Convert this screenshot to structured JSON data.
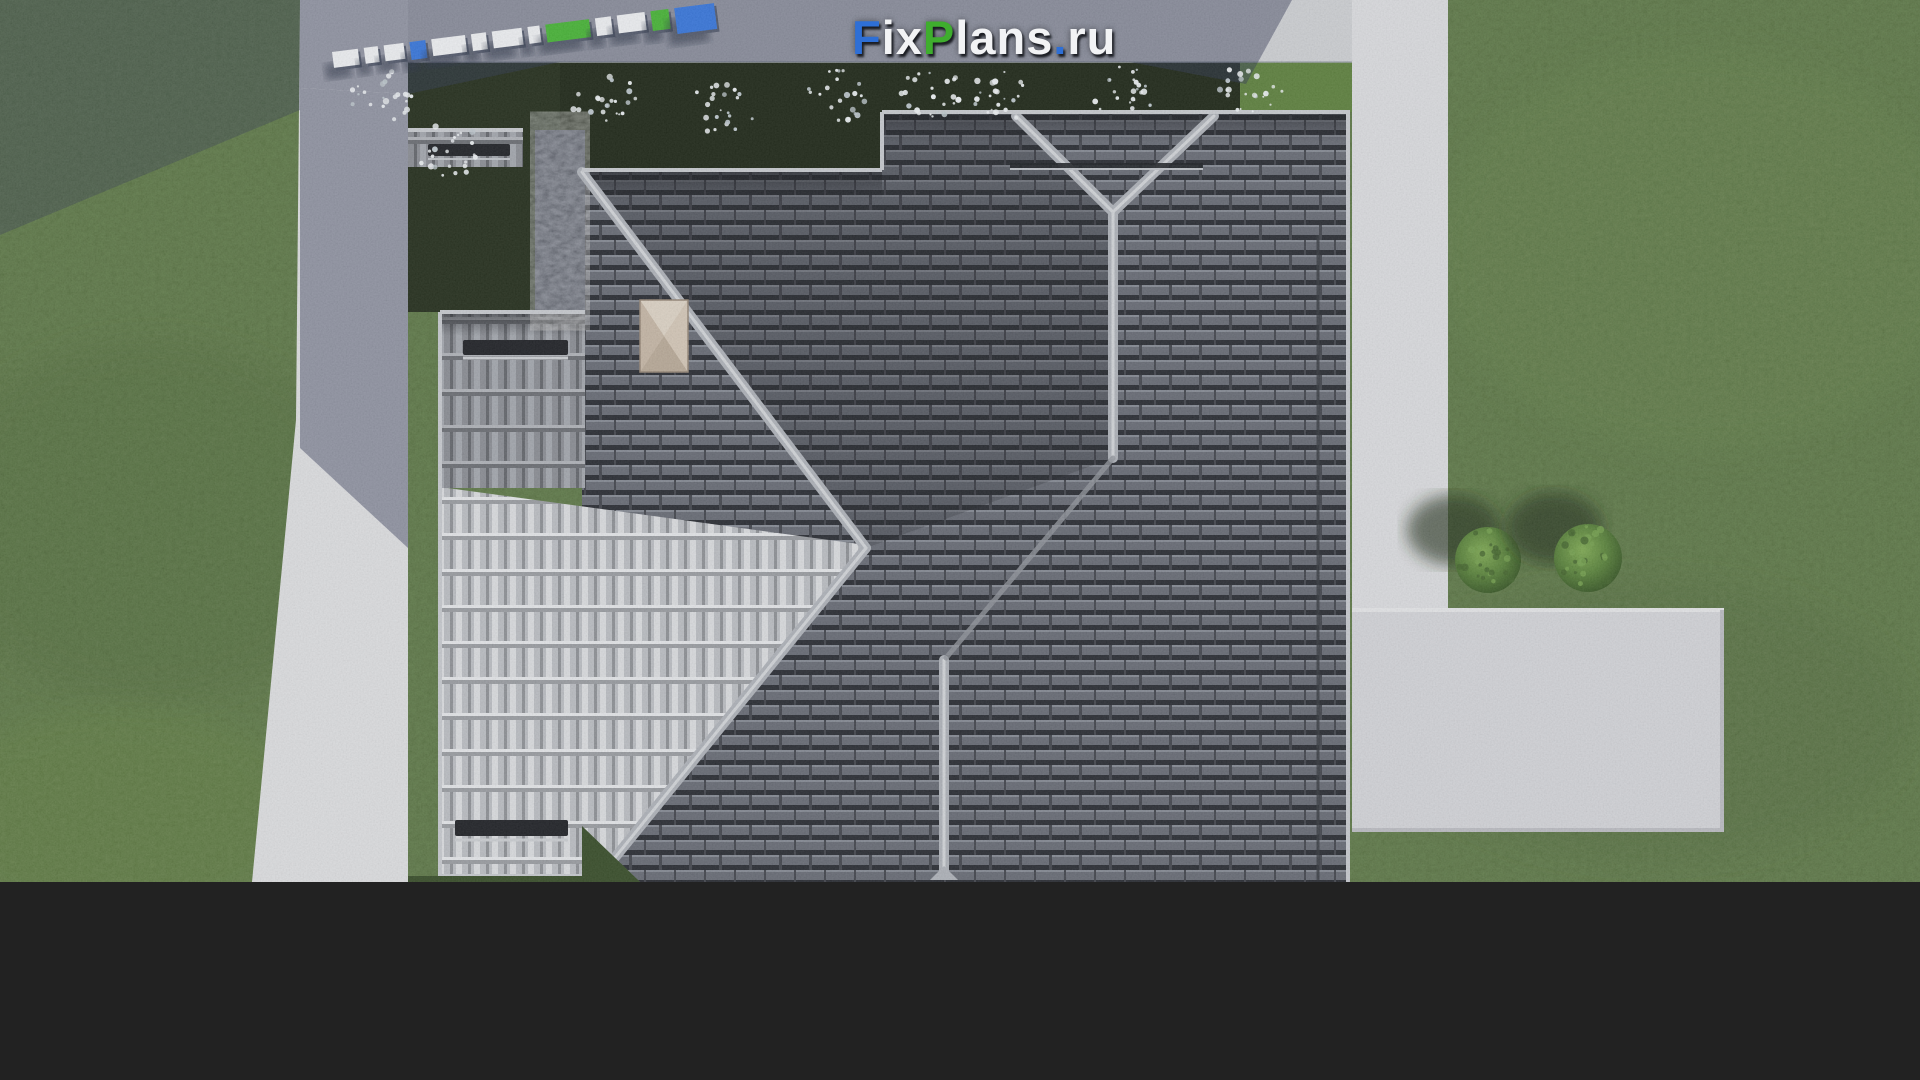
{
  "site": {
    "watermark_text": "FixPlans.ru",
    "watermark_segments": [
      {
        "text": "F",
        "color": "#2e6fd6"
      },
      {
        "text": "ix",
        "color": "#f2f3f5"
      },
      {
        "text": "P",
        "color": "#3fae2e"
      },
      {
        "text": "lans",
        "color": "#f2f3f5"
      },
      {
        "text": ".",
        "color": "#2e6fd6"
      },
      {
        "text": "ru",
        "color": "#f2f3f5"
      }
    ]
  },
  "ground_logo": {
    "label": "FixPlans.ru extruded 3D letters lying on the paving",
    "block_colors": [
      "#e9ebee",
      "#e9ebee",
      "#e9ebee",
      "#2f6fd6",
      "#e9ebee",
      "#e9ebee",
      "#e9ebee",
      "#e9ebee",
      "#3fae2e",
      "#e9ebee",
      "#e9ebee",
      "#3fae2e",
      "#2f6fd6"
    ]
  },
  "scene": {
    "description": "Aerial top-down 3D render of a single-family house hip roof with dark concrete tiles, a sunlit light tile slope, ridge caps, chimney and snow guards, surrounded by lawn, concrete sidewalks, a rear patio, flower planters and trimmed shrubs",
    "elements": {
      "house_roof": "dark tiled hip roof",
      "sunlit_slope": "light sunlit tile slope (south-west)",
      "garage_wing": "left wing roof",
      "chimney": "plastered chimney with pyramid cap",
      "snow_guards": "dark snow-guard bars on slopes",
      "planters": "dark planting beds with white flowering shrubs",
      "bushes": "two round trimmed shrubs on right lawn",
      "left_sidewalk": "concrete sidewalk along left side",
      "right_sidewalk": "concrete sidewalk along right side",
      "patio": "rear concrete patio, bottom right",
      "lawn": "green lawn",
      "building_shadow": "building shadow cast to the upper left"
    }
  },
  "palette": {
    "grass": "#4c6a33",
    "grass_bright": "#567a36",
    "grass_dark": "#2e4420",
    "planter_bed": "#151f0e",
    "pavement_lit": "#d7d8db",
    "pavement_patio": "#cfd0d4",
    "pavement_shadow": "#2b3150",
    "roof_dark_tile": "#5b5f69",
    "roof_light_tile": "#b6b9be",
    "roof_medium_tile": "#84878e",
    "ridge_cap": "#a9adb4",
    "fascia_trim": "#c2c5ca",
    "chimney": "#c9bbaa",
    "bush_green": "#527c33",
    "flower_white": "#e9edf0"
  }
}
